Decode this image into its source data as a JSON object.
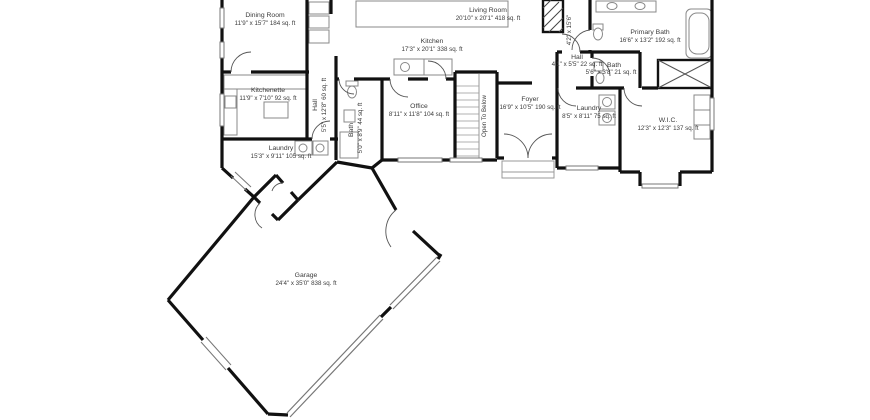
{
  "page": {
    "background": "#ffffff"
  },
  "colors": {
    "wall": "#111111",
    "fixture": "#888888",
    "door_arc": "#555555",
    "window": "#777777",
    "text": "#3b3b3b"
  },
  "rooms": {
    "dining": {
      "name": "Dining Room",
      "dims": "11'9\" x 15'7\" 184 sq. ft"
    },
    "kitchen": {
      "name": "Kitchen",
      "dims": "17'3\" x 20'1\" 338 sq. ft"
    },
    "living": {
      "name": "Living Room",
      "dims": "20'10\" x 20'1\" 418 sq. ft"
    },
    "hall_upper": {
      "dims": "4'2\" x 15'6\""
    },
    "primary_bath": {
      "name": "Primary Bath",
      "dims": "16'6\" x 13'2\" 192 sq. ft"
    },
    "hall_right": {
      "name": "Hall",
      "dims": "4'1\" x 5'5\" 22 sq. ft"
    },
    "bath_right": {
      "name": "Bath",
      "dims": "5'6\" x 3'8\" 21 sq. ft"
    },
    "wic": {
      "name": "W.I.C.",
      "dims": "12'3\" x 12'3\" 137 sq. ft"
    },
    "laundry_right": {
      "name": "Laundry",
      "dims": "8'5\" x 8'11\" 75 sq. ft"
    },
    "foyer": {
      "name": "Foyer",
      "dims": "16'9\" x 10'5\" 190 sq. ft"
    },
    "office": {
      "name": "Office",
      "dims": "8'11\" x 11'8\" 104 sq. ft"
    },
    "stairs": {
      "label": "Open To Below"
    },
    "bath_left": {
      "name": "Bath",
      "dims": "5'0\" x 8'9\" 44 sq. ft"
    },
    "hall_left": {
      "name": "Hall",
      "dims": "5'5\" x 12'8\" 60 sq. ft"
    },
    "kitchenette": {
      "name": "Kitchenette",
      "dims": "11'9\" x 7'10\" 92 sq. ft"
    },
    "laundry_left": {
      "name": "Laundry",
      "dims": "15'3\" x 9'11\" 105 sq. ft"
    },
    "garage": {
      "name": "Garage",
      "dims": "24'4\" x 35'0\" 838 sq. ft"
    }
  }
}
